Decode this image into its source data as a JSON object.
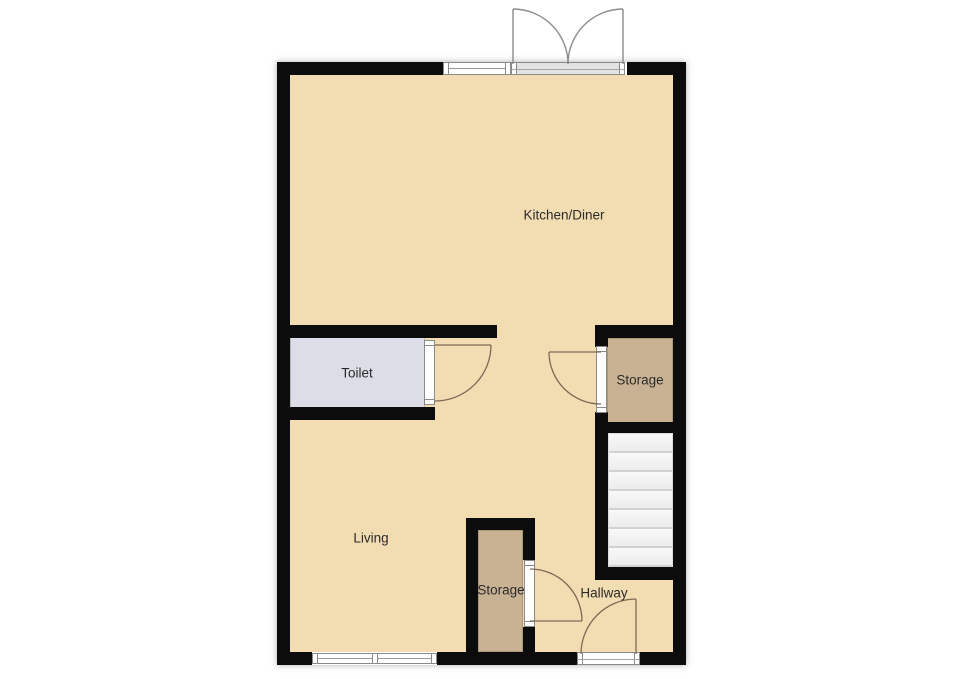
{
  "rooms": {
    "kitchen_diner": "Kitchen/Diner",
    "toilet": "Toilet",
    "storage_upper": "Storage",
    "living": "Living",
    "storage_lower": "Storage",
    "hallway": "Hallway"
  },
  "colors": {
    "floor": "#f2dcb1",
    "toilet_floor": "#dbdde7",
    "storage_floor": "#c9b293",
    "wall": "#0c0c0c",
    "door_swing": "#7d6a55",
    "french_door": "#8c8c8c",
    "label_text": "#2b2b2b"
  },
  "features": [
    "french-patio-doors-top",
    "window-top-wall",
    "toilet-door",
    "storage-upper-door",
    "staircase-7-treads",
    "closet-door",
    "front-entrance-door",
    "window-bottom-wall"
  ]
}
